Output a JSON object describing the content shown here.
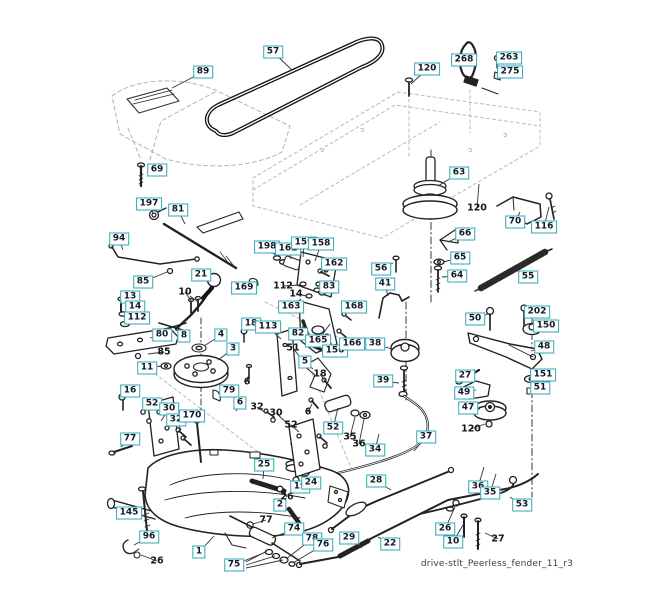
{
  "caption": "drive-stlt_Peerless_fender_11_r3",
  "colors": {
    "label_border": "#2fa7b8",
    "label_text": "#0e1a26",
    "leader": "#333333",
    "line": "#222222",
    "ghost": "#b5b5b5"
  },
  "boxed_labels": [
    {
      "t": "57",
      "x": 273,
      "y": 52,
      "lx": 292,
      "ly": 70
    },
    {
      "t": "89",
      "x": 203,
      "y": 72,
      "lx": 172,
      "ly": 88
    },
    {
      "t": "120",
      "x": 427,
      "y": 69,
      "lx": 411,
      "ly": 84
    },
    {
      "t": "268",
      "x": 464,
      "y": 60,
      "lx": 476,
      "ly": 58
    },
    {
      "t": "263",
      "x": 509,
      "y": 58,
      "lx": 500,
      "ly": 59
    },
    {
      "t": "275",
      "x": 510,
      "y": 72,
      "lx": 501,
      "ly": 73
    },
    {
      "t": "69",
      "x": 157,
      "y": 170,
      "lx": 147,
      "ly": 172
    },
    {
      "t": "197",
      "x": 149,
      "y": 204,
      "lx": 153,
      "ly": 213
    },
    {
      "t": "81",
      "x": 178,
      "y": 210,
      "lx": 185,
      "ly": 224
    },
    {
      "t": "63",
      "x": 459,
      "y": 173,
      "lx": 438,
      "ly": 186
    },
    {
      "t": "70",
      "x": 515,
      "y": 222,
      "lx": 520,
      "ly": 212
    },
    {
      "t": "116",
      "x": 544,
      "y": 227,
      "lx": 549,
      "ly": 207
    },
    {
      "t": "66",
      "x": 465,
      "y": 234,
      "lx": 448,
      "ly": 242
    },
    {
      "t": "94",
      "x": 119,
      "y": 239,
      "lx": 123,
      "ly": 250
    },
    {
      "t": "85",
      "x": 143,
      "y": 282,
      "lx": 167,
      "ly": 272
    },
    {
      "t": "21",
      "x": 201,
      "y": 275,
      "lx": 210,
      "ly": 279
    },
    {
      "t": "198",
      "x": 267,
      "y": 247,
      "lx": 276,
      "ly": 256
    },
    {
      "t": "161",
      "x": 288,
      "y": 249,
      "lx": 291,
      "ly": 259
    },
    {
      "t": "159",
      "x": 304,
      "y": 243,
      "lx": 303,
      "ly": 257
    },
    {
      "t": "158",
      "x": 321,
      "y": 244,
      "lx": 315,
      "ly": 261
    },
    {
      "t": "162",
      "x": 334,
      "y": 264,
      "lx": 324,
      "ly": 272
    },
    {
      "t": "169",
      "x": 244,
      "y": 288,
      "lx": 252,
      "ly": 283
    },
    {
      "t": "83",
      "x": 329,
      "y": 287,
      "lx": 320,
      "ly": 291
    },
    {
      "t": "56",
      "x": 381,
      "y": 269,
      "lx": 393,
      "ly": 263
    },
    {
      "t": "41",
      "x": 385,
      "y": 284,
      "lx": 388,
      "ly": 296
    },
    {
      "t": "65",
      "x": 460,
      "y": 258,
      "lx": 443,
      "ly": 262
    },
    {
      "t": "64",
      "x": 457,
      "y": 276,
      "lx": 442,
      "ly": 277
    },
    {
      "t": "55",
      "x": 528,
      "y": 277,
      "lx": 513,
      "ly": 268
    },
    {
      "t": "13",
      "x": 130,
      "y": 297,
      "lx": 122,
      "ly": 302
    },
    {
      "t": "14",
      "x": 135,
      "y": 307,
      "lx": 124,
      "ly": 313
    },
    {
      "t": "112",
      "x": 137,
      "y": 318,
      "lx": 126,
      "ly": 323
    },
    {
      "t": "163",
      "x": 291,
      "y": 307,
      "lx": 301,
      "ly": 299
    },
    {
      "t": "168",
      "x": 354,
      "y": 307,
      "lx": 345,
      "ly": 313
    },
    {
      "t": "80",
      "x": 162,
      "y": 335,
      "lx": 150,
      "ly": 338
    },
    {
      "t": "18",
      "x": 251,
      "y": 324,
      "lx": 245,
      "ly": 330
    },
    {
      "t": "113",
      "x": 268,
      "y": 327,
      "lx": 281,
      "ly": 339
    },
    {
      "t": "82",
      "x": 298,
      "y": 334,
      "lx": 304,
      "ly": 325
    },
    {
      "t": "165",
      "x": 318,
      "y": 341,
      "lx": 330,
      "ly": 324
    },
    {
      "t": "156",
      "x": 335,
      "y": 351,
      "lx": 328,
      "ly": 337
    },
    {
      "t": "166",
      "x": 352,
      "y": 344,
      "lx": 340,
      "ly": 332
    },
    {
      "t": "38",
      "x": 375,
      "y": 344,
      "lx": 392,
      "ly": 349
    },
    {
      "t": "50",
      "x": 475,
      "y": 319,
      "lx": 488,
      "ly": 314
    },
    {
      "t": "202",
      "x": 537,
      "y": 312,
      "lx": 526,
      "ly": 311
    },
    {
      "t": "150",
      "x": 546,
      "y": 326,
      "lx": 540,
      "ly": 328
    },
    {
      "t": "48",
      "x": 544,
      "y": 347,
      "lx": 531,
      "ly": 351
    },
    {
      "t": "27",
      "x": 465,
      "y": 376,
      "lx": 476,
      "ly": 373
    },
    {
      "t": "151",
      "x": 543,
      "y": 375,
      "lx": 537,
      "ly": 378
    },
    {
      "t": "51",
      "x": 540,
      "y": 388,
      "lx": 532,
      "ly": 390
    },
    {
      "t": "49",
      "x": 464,
      "y": 393,
      "lx": 476,
      "ly": 390
    },
    {
      "t": "47",
      "x": 468,
      "y": 408,
      "lx": 480,
      "ly": 409
    },
    {
      "t": "39",
      "x": 383,
      "y": 381,
      "lx": 399,
      "ly": 383
    },
    {
      "t": "11",
      "x": 147,
      "y": 368,
      "lx": 161,
      "ly": 366
    },
    {
      "t": "16",
      "x": 130,
      "y": 391,
      "lx": 123,
      "ly": 396
    },
    {
      "t": "52",
      "x": 152,
      "y": 404,
      "lx": 145,
      "ly": 411
    },
    {
      "t": "30",
      "x": 169,
      "y": 409,
      "lx": 161,
      "ly": 421
    },
    {
      "t": "32",
      "x": 176,
      "y": 420,
      "lx": 181,
      "ly": 430
    },
    {
      "t": "170",
      "x": 192,
      "y": 416,
      "lx": 197,
      "ly": 425
    },
    {
      "t": "77",
      "x": 130,
      "y": 439,
      "lx": 121,
      "ly": 447
    },
    {
      "t": "79",
      "x": 229,
      "y": 391,
      "lx": 218,
      "ly": 394
    },
    {
      "t": "6",
      "x": 240,
      "y": 403,
      "lx": 236,
      "ly": 411
    },
    {
      "t": "5",
      "x": 305,
      "y": 362,
      "lx": 313,
      "ly": 369
    },
    {
      "t": "3",
      "x": 233,
      "y": 349,
      "lx": 218,
      "ly": 360
    },
    {
      "t": "4",
      "x": 221,
      "y": 335,
      "lx": 204,
      "ly": 346
    },
    {
      "t": "8",
      "x": 184,
      "y": 336,
      "lx": 176,
      "ly": 330
    },
    {
      "t": "52",
      "x": 333,
      "y": 428,
      "lx": 338,
      "ly": 408
    },
    {
      "t": "34",
      "x": 375,
      "y": 450,
      "lx": 379,
      "ly": 434
    },
    {
      "t": "37",
      "x": 426,
      "y": 437,
      "lx": 414,
      "ly": 451
    },
    {
      "t": "25",
      "x": 264,
      "y": 465,
      "lx": 263,
      "ly": 479
    },
    {
      "t": "19",
      "x": 300,
      "y": 487,
      "lx": 296,
      "ly": 481
    },
    {
      "t": "24",
      "x": 311,
      "y": 483,
      "lx": 305,
      "ly": 475
    },
    {
      "t": "2",
      "x": 280,
      "y": 505,
      "lx": 290,
      "ly": 512
    },
    {
      "t": "145",
      "x": 129,
      "y": 513,
      "lx": 141,
      "ly": 507
    },
    {
      "t": "96",
      "x": 149,
      "y": 537,
      "lx": 134,
      "ly": 545
    },
    {
      "t": "1",
      "x": 199,
      "y": 552,
      "lx": 214,
      "ly": 536
    },
    {
      "t": "74",
      "x": 294,
      "y": 529,
      "lx": 272,
      "ly": 538
    },
    {
      "t": "75",
      "x": 234,
      "y": 565,
      "lx": 266,
      "ly": 552
    },
    {
      "t": "78",
      "x": 312,
      "y": 539,
      "lx": 286,
      "ly": 559
    },
    {
      "t": "76",
      "x": 323,
      "y": 545,
      "lx": 293,
      "ly": 563
    },
    {
      "t": "28",
      "x": 376,
      "y": 481,
      "lx": 391,
      "ly": 490
    },
    {
      "t": "29",
      "x": 349,
      "y": 538,
      "lx": 362,
      "ly": 548
    },
    {
      "t": "22",
      "x": 390,
      "y": 544,
      "lx": 378,
      "ly": 537
    },
    {
      "t": "26",
      "x": 445,
      "y": 529,
      "lx": 455,
      "ly": 507
    },
    {
      "t": "10",
      "x": 453,
      "y": 542,
      "lx": 463,
      "ly": 525
    },
    {
      "t": "53",
      "x": 522,
      "y": 505,
      "lx": 510,
      "ly": 497
    },
    {
      "t": "36",
      "x": 478,
      "y": 487,
      "lx": 484,
      "ly": 467
    },
    {
      "t": "35",
      "x": 490,
      "y": 493,
      "lx": 496,
      "ly": 474
    }
  ],
  "plain_labels": [
    {
      "t": "120",
      "x": 477,
      "y": 208,
      "lx": 479,
      "ly": 184
    },
    {
      "t": "112",
      "x": 283,
      "y": 286,
      "lx": 300,
      "ly": 285
    },
    {
      "t": "14",
      "x": 296,
      "y": 294,
      "lx": 307,
      "ly": 296
    },
    {
      "t": "10",
      "x": 185,
      "y": 292,
      "lx": 192,
      "ly": 302
    },
    {
      "t": "85",
      "x": 164,
      "y": 352,
      "lx": 148,
      "ly": 354
    },
    {
      "t": "51",
      "x": 293,
      "y": 348,
      "lx": 299,
      "ly": 356
    },
    {
      "t": "6",
      "x": 247,
      "y": 382,
      "lx": 249,
      "ly": 373
    },
    {
      "t": "18",
      "x": 320,
      "y": 374,
      "lx": 326,
      "ly": 382
    },
    {
      "t": "32",
      "x": 257,
      "y": 407,
      "lx": 266,
      "ly": 413
    },
    {
      "t": "30",
      "x": 276,
      "y": 413,
      "lx": 290,
      "ly": 426
    },
    {
      "t": "52",
      "x": 291,
      "y": 425,
      "lx": 299,
      "ly": 432
    },
    {
      "t": "6",
      "x": 308,
      "y": 412,
      "lx": 312,
      "ly": 404
    },
    {
      "t": "35",
      "x": 350,
      "y": 437,
      "lx": 355,
      "ly": 417
    },
    {
      "t": "36",
      "x": 359,
      "y": 444,
      "lx": 364,
      "ly": 419
    },
    {
      "t": "26",
      "x": 287,
      "y": 497,
      "lx": 281,
      "ly": 490
    },
    {
      "t": "77",
      "x": 266,
      "y": 520,
      "lx": 253,
      "ly": 524
    },
    {
      "t": "26",
      "x": 157,
      "y": 561,
      "lx": 141,
      "ly": 555
    },
    {
      "t": "120",
      "x": 471,
      "y": 429,
      "lx": 485,
      "ly": 424
    },
    {
      "t": "27",
      "x": 498,
      "y": 539,
      "lx": 485,
      "ly": 533
    }
  ],
  "extra_leaders": [
    [
      246,
      562,
      267,
      551
    ],
    [
      246,
      565,
      275,
      556
    ],
    [
      246,
      568,
      283,
      560
    ],
    [
      190,
      296,
      198,
      302
    ]
  ]
}
